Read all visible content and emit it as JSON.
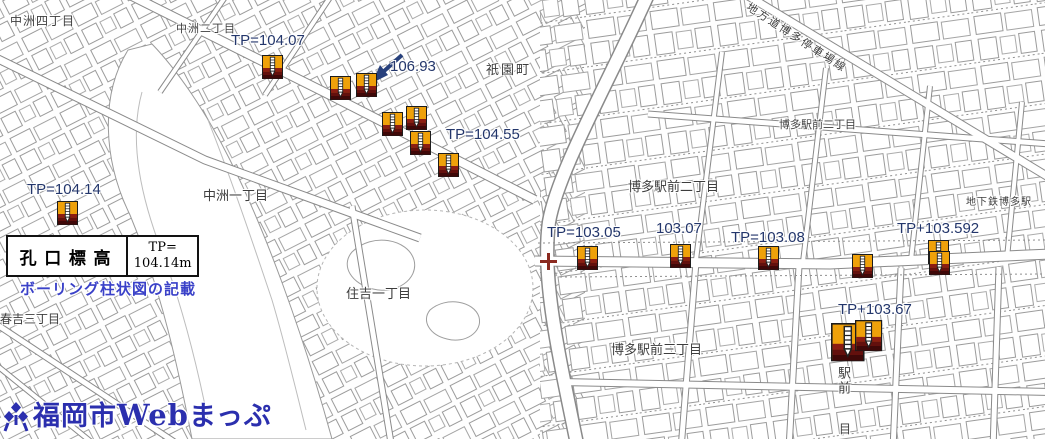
{
  "app": {
    "logo_city": "福岡市",
    "logo_web": "Web",
    "logo_suffix": "まっぷ"
  },
  "legend": {
    "heading": "孔口標高",
    "value_line1": "TP=",
    "value_line2": "104.14m",
    "note": "ボーリング柱状図の記載"
  },
  "map": {
    "elevation_labels": [
      {
        "text": "TP=104.07",
        "x": 231,
        "y": 33
      },
      {
        "text": "106.93",
        "x": 390,
        "y": 59
      },
      {
        "text": "TP=104.55",
        "x": 446,
        "y": 127
      },
      {
        "text": "TP=104.14",
        "x": 27,
        "y": 182
      },
      {
        "text": "TP=103.05",
        "x": 547,
        "y": 225
      },
      {
        "text": "103.07",
        "x": 656,
        "y": 221
      },
      {
        "text": "TP=103.08",
        "x": 731,
        "y": 230
      },
      {
        "text": "TP+103.592",
        "x": 897,
        "y": 221
      },
      {
        "text": "TP+103.67",
        "x": 838,
        "y": 302
      }
    ],
    "place_labels": [
      {
        "text": "中洲四丁目",
        "x": 10,
        "y": 15,
        "size": 12,
        "spacing": 1
      },
      {
        "text": "中洲二丁目",
        "x": 176,
        "y": 24,
        "size": 11,
        "spacing": 1
      },
      {
        "text": "祇園町",
        "x": 486,
        "y": 63,
        "size": 13,
        "spacing": 2
      },
      {
        "text": "中洲一丁目",
        "x": 203,
        "y": 189,
        "size": 13,
        "spacing": 0
      },
      {
        "text": "博多駅前二丁目",
        "x": 779,
        "y": 120,
        "size": 11,
        "spacing": 0
      },
      {
        "text": "博多駅前二丁目",
        "x": 628,
        "y": 180,
        "size": 13,
        "spacing": 0
      },
      {
        "text": "地下鉄博多駅",
        "x": 966,
        "y": 198,
        "size": 10,
        "spacing": 1
      },
      {
        "text": "博多駅前三丁目",
        "x": 611,
        "y": 343,
        "size": 13,
        "spacing": 0
      },
      {
        "text": "住吉一丁目",
        "x": 346,
        "y": 287,
        "size": 13,
        "spacing": 0
      },
      {
        "text": "春吉三丁目",
        "x": 0,
        "y": 313,
        "size": 12,
        "spacing": 0
      },
      {
        "text": "地方道博多停車場線",
        "x": 750,
        "y": 2,
        "size": 11,
        "spacing": 2,
        "rotate": 33
      },
      {
        "text": "駅前",
        "x": 837,
        "y": 366,
        "size": 13,
        "vertical": true
      },
      {
        "text": "目",
        "x": 839,
        "y": 423,
        "size": 12
      }
    ],
    "markers": [
      {
        "x": 262,
        "y": 55
      },
      {
        "x": 330,
        "y": 76
      },
      {
        "x": 356,
        "y": 73
      },
      {
        "x": 382,
        "y": 112
      },
      {
        "x": 406,
        "y": 106
      },
      {
        "x": 410,
        "y": 131
      },
      {
        "x": 438,
        "y": 153
      },
      {
        "x": 57,
        "y": 201
      },
      {
        "x": 577,
        "y": 246
      },
      {
        "x": 670,
        "y": 244
      },
      {
        "x": 758,
        "y": 246
      },
      {
        "x": 852,
        "y": 254
      },
      {
        "x": 928,
        "y": 240
      },
      {
        "x": 929,
        "y": 251
      },
      {
        "x": 831,
        "y": 323,
        "s": 1.6
      },
      {
        "x": 855,
        "y": 320,
        "s": 1.3
      }
    ],
    "cross": {
      "x": 539,
      "y": 252
    },
    "colors": {
      "marker_orange": "#efa10a",
      "marker_band1": "#8c1d12",
      "marker_band2": "#63100d",
      "marker_band3": "#3f0808",
      "elevation_text": "#23366b",
      "note_text": "#3a41c8",
      "logo": "#2b2fae",
      "cross": "#8b2a20",
      "arrow": "#27407c"
    }
  }
}
